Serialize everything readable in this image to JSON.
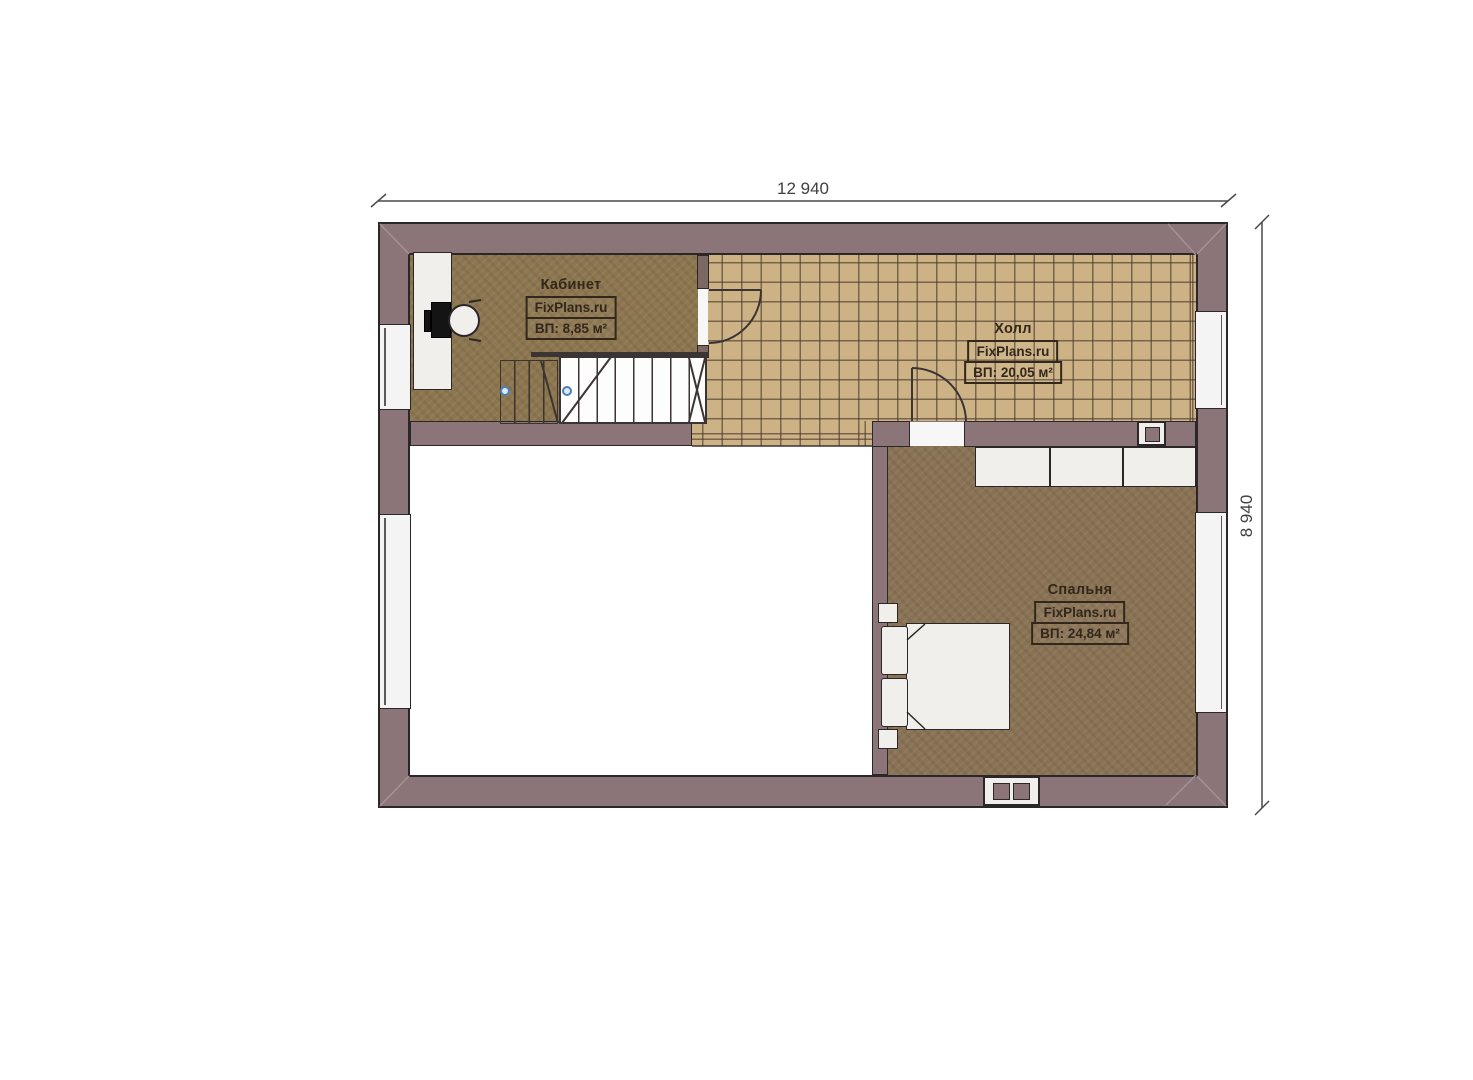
{
  "plan": {
    "title": "floor-plan",
    "dimensions": {
      "top": "12 940",
      "right": "8 940"
    },
    "rooms": {
      "office": {
        "name": "Кабинет",
        "brand": "FixPlans.ru",
        "area": "ВП: 8,85 м²"
      },
      "hall": {
        "name": "Холл",
        "brand": "FixPlans.ru",
        "area": "ВП: 20,05 м²"
      },
      "bedroom": {
        "name": "Спальня",
        "brand": "FixPlans.ru",
        "area": "ВП: 24,84 м²"
      }
    },
    "colors": {
      "wall": "#8b7578",
      "wall_outline": "#2b2628",
      "wood_floor": "#8c764f",
      "tile_floor": "#cdb286",
      "tile_line": "#4a3a2c",
      "label_text": "#32271a",
      "dimension_text": "#3f3f3f",
      "handrail_post": "#4b80bb",
      "window_fill": "#f4f4f4",
      "furniture_fill": "#f0efec"
    }
  }
}
